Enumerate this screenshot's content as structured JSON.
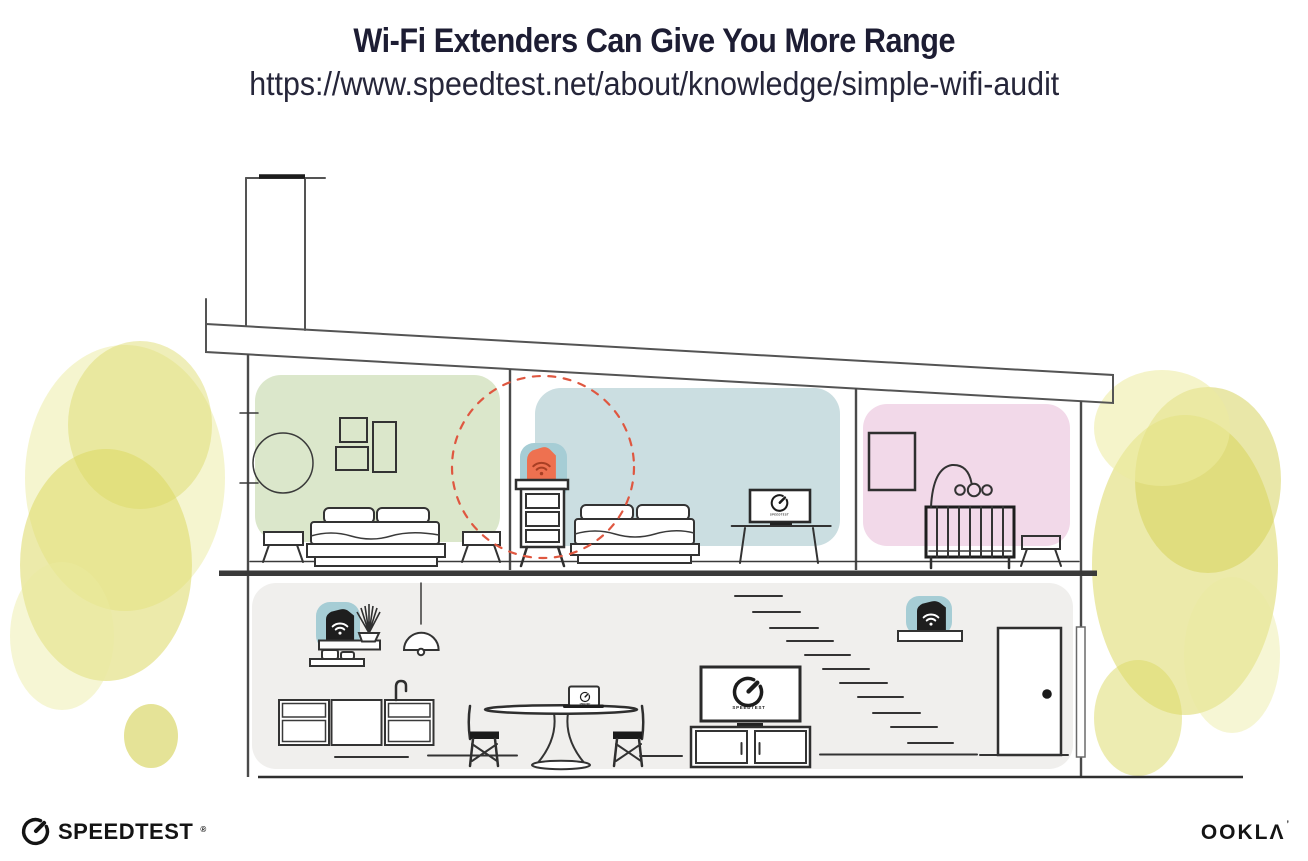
{
  "header": {
    "title": "Wi-Fi Extenders Can Give You More Range",
    "url": "https://www.speedtest.net/about/knowledge/simple-wifi-audit"
  },
  "illustration": {
    "bedroom_tv_label": "SPEEDTEST",
    "living_tv_label": "SPEEDTEST",
    "laptop_label": "SPEEDTEST",
    "devices": {
      "bedroom_extender": "wifi-extender-on-dresser",
      "living_room_router": "wifi-router-on-shelf",
      "hall_extender": "wifi-extender-on-shelf"
    },
    "icons": {
      "wifi": "wifi-icon",
      "gauge": "speedtest-gauge-icon"
    },
    "colors": {
      "room_green": "#dbe7cb",
      "room_blue": "#cbdee1",
      "room_pink": "#f2d9e9",
      "ground_floor": "#f0efed",
      "device_halo": "#a6cdd5",
      "device_dark": "#1e1e1e",
      "extender_orange": "#ee7150",
      "extender_wifi": "#a83f24",
      "range_circle": "#df5740",
      "foliage": "#dcd964",
      "foliage_light": "#eceb9f",
      "foliage_dark": "#d3d052"
    }
  },
  "footer": {
    "speedtest_wordmark": "SPEEDTEST",
    "speedtest_reg_mark": "®",
    "ookla_wordmark": "OOKLΛ",
    "ookla_trade_mark": "’"
  }
}
